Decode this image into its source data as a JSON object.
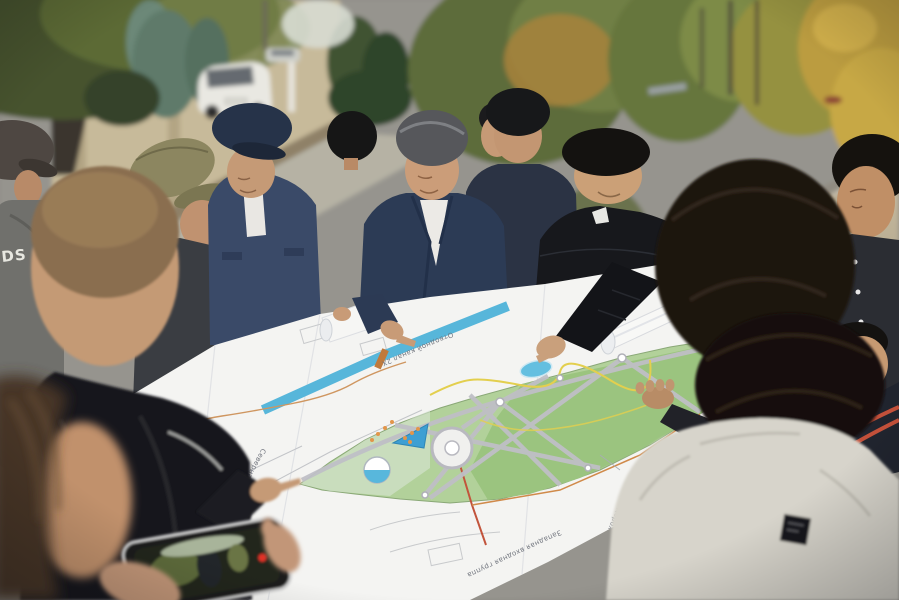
{
  "scene": {
    "summary": "Outdoor photograph: a group of officials and residents gathered in a circle on a street, studying a large unrolled park master-plan drawing. Autumn trees line an unpaved gravel road behind them; a beige fence wall, a big tree and parked cars are on the left. A woman in the foreground films the meeting on a smartphone."
  },
  "people": [
    {
      "id": "man-cap-left-edge",
      "appearance": "dark cap, grey-green jacket with white lettering",
      "print": "DS"
    },
    {
      "id": "man-buzzcut-foreground",
      "appearance": "short brown hair, black puffer vest, back to camera, pointing at plan"
    },
    {
      "id": "man-olive-cap",
      "appearance": "olive baseball cap, dark grey jacket, looking down"
    },
    {
      "id": "man-navy-cap",
      "appearance": "navy baseball cap, navy overshirt with chest pockets, white t-shirt"
    },
    {
      "id": "man-back-head-small",
      "appearance": "black hair, back to camera"
    },
    {
      "id": "official-navy-blazer",
      "appearance": "grey combed-back hair, navy blazer, white polo, reading the plan"
    },
    {
      "id": "man-partial-face",
      "appearance": "black hair, face partly hidden between others"
    },
    {
      "id": "man-navy-shirt",
      "appearance": "black hair, dark navy shirt, looking down"
    },
    {
      "id": "man-black-puffer",
      "appearance": "black quilted puffer jacket, white shirt collar, smiling and pointing at the plan"
    },
    {
      "id": "man-back-head-large",
      "appearance": "dark hair, large back-of-head in right foreground, arm holding plan edge"
    },
    {
      "id": "man-far-right",
      "appearance": "black hair, dark snap-button jacket, glancing sideways"
    },
    {
      "id": "person-red-trim-collar",
      "appearance": "dark jacket with orange-red collar stripes, partly hidden"
    },
    {
      "id": "man-grey-sweatshirt",
      "appearance": "light grey sweatshirt with small black square patch, back to camera"
    },
    {
      "id": "woman-filming",
      "appearance": "brown hair, blurred foreground, filming with smartphone"
    }
  ],
  "map": {
    "kind": "landscape park master plan, paper sheets held flat by the group",
    "labels": [
      {
        "text": "Северная входная группа"
      },
      {
        "text": "Западная входная группа"
      },
      {
        "text": "прогулочная дорожка 1,25м"
      },
      {
        "text": "Тип II 685м"
      },
      {
        "text": "Отводной канал 2Х"
      }
    ],
    "features": [
      "blue canal strip with orange bridge tick",
      "light-green park ribbon",
      "darker green zone with red boundary line",
      "radiating grey alleys with node circles",
      "roundabout plaza",
      "half-blue fountain circle",
      "blue triangle with orange dots",
      "small blue lake at pointing finger",
      "yellow winding paths",
      "faint pencil sketch blocks"
    ],
    "colors": {
      "paper": "#f4f4f2",
      "park_light": "#b2d19a",
      "park_dark": "#9bc47f",
      "canal": "#57b6da",
      "alley": "#bfbfc6",
      "accent_orange": "#d08a4a",
      "boundary_red": "#c2543c",
      "lake": "#64bfe0"
    }
  },
  "vehicles": [
    {
      "id": "white-wagon"
    },
    {
      "id": "silver-car"
    }
  ],
  "smartphone": {
    "status": "recording",
    "indicator_color": "#e23326"
  },
  "environment": {
    "wall_color": "#c7ba9a",
    "asphalt_color": "#96948e",
    "gravel_road_color": "#b9ab90",
    "foliage_palette": [
      "#5d6c3a",
      "#6f7f44",
      "#a8823c",
      "#c7a845",
      "#46522e"
    ]
  }
}
